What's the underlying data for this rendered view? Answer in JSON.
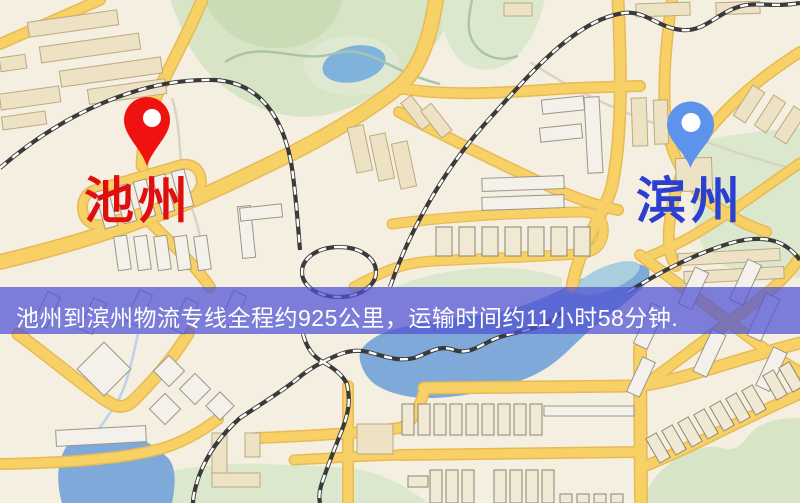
{
  "map": {
    "origin": {
      "label": "池州"
    },
    "destination": {
      "label": "滨州"
    },
    "banner": {
      "text": "池州到滨州物流专线全程约925公里，运输时间约11小时58分钟."
    }
  },
  "palette": {
    "map-bg": "#f5efe1",
    "park": "#d7e4c6",
    "water": "#7fa9d8",
    "road": "#f7d166",
    "road-casing": "#e7ba55",
    "building": "#ede2c4",
    "railway": "#3a3a3a",
    "banner-bg": "rgba(78,80,212,0.72)",
    "banner-text": "#ffffff",
    "origin-pin": "#ee1310",
    "dest-pin": "#5e93ec",
    "origin-label": "#e00f0f",
    "dest-label": "#2b3fd0"
  }
}
